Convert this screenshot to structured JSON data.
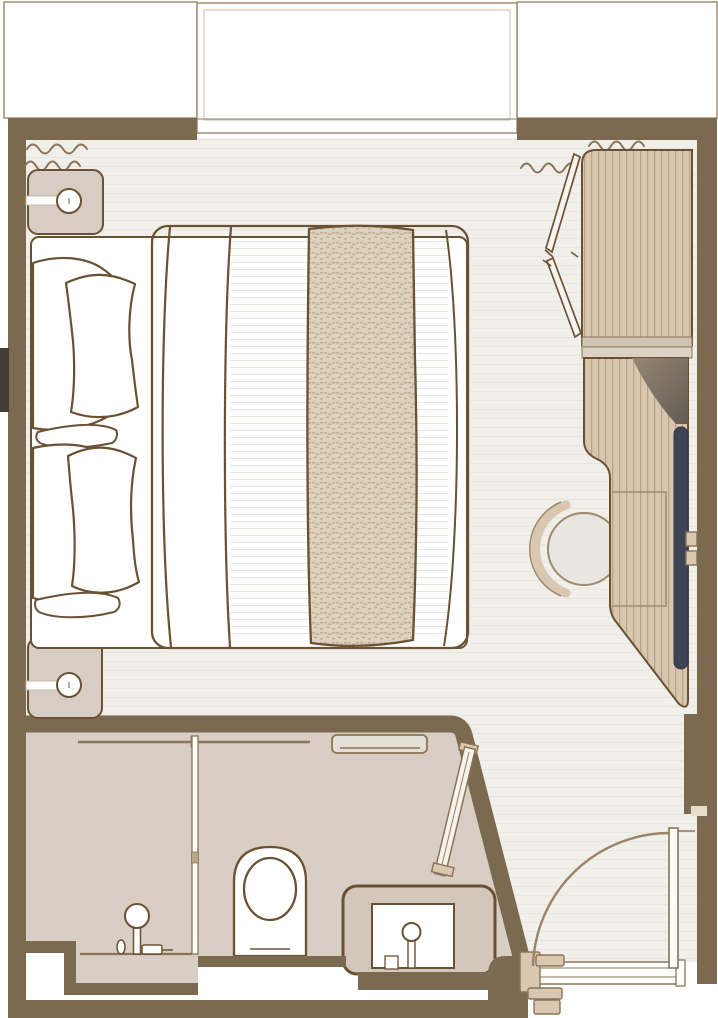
{
  "plan": {
    "kind": "stateroom-floor-plan",
    "rooms": [
      {
        "name": "balcony",
        "items": [
          "balcony-left",
          "balcony-window",
          "balcony-right"
        ]
      },
      {
        "name": "bedroom",
        "items": [
          "double-bed",
          "pillows",
          "knit-throw",
          "nightstand-top",
          "nightstand-bottom",
          "wall-lamp-top",
          "wall-lamp-bottom",
          "curtains-left",
          "curtains-right",
          "wardrobe",
          "wardrobe-open-doors",
          "desk",
          "stool",
          "tv-panel"
        ]
      },
      {
        "name": "bathroom",
        "items": [
          "shower",
          "shower-glass-partition",
          "shower-rail",
          "toilet",
          "towel-shelf",
          "vanity-sink",
          "sliding-door"
        ]
      },
      {
        "name": "entry",
        "items": [
          "entry-door",
          "door-swing-arc",
          "door-threshold"
        ]
      }
    ]
  },
  "palette": {
    "wall": "#7b6a50",
    "line": "#6b5134",
    "lineSoft": "#8a7356",
    "balconyLine": "#a8947a",
    "floor": "#f1efea",
    "floorLine": "#e6e3dc",
    "bedLine": "#e9e5de",
    "bath": "#d8cec3",
    "counter": "#d2c7ba",
    "wood": "#d8c6b0",
    "woodStripe": "#bca285",
    "throw": "#ded2bf",
    "throwStitch": "#b3a188",
    "upholstery": "#e9e6e1",
    "stoolLine": "#a08a6c",
    "tvPanel": "#3e4455",
    "nightstand": "#d7cdc4",
    "hardware": "#d9c7b1",
    "notch": "#433d35",
    "shelfDark1": "#968674",
    "shelfDark2": "#635c52"
  }
}
